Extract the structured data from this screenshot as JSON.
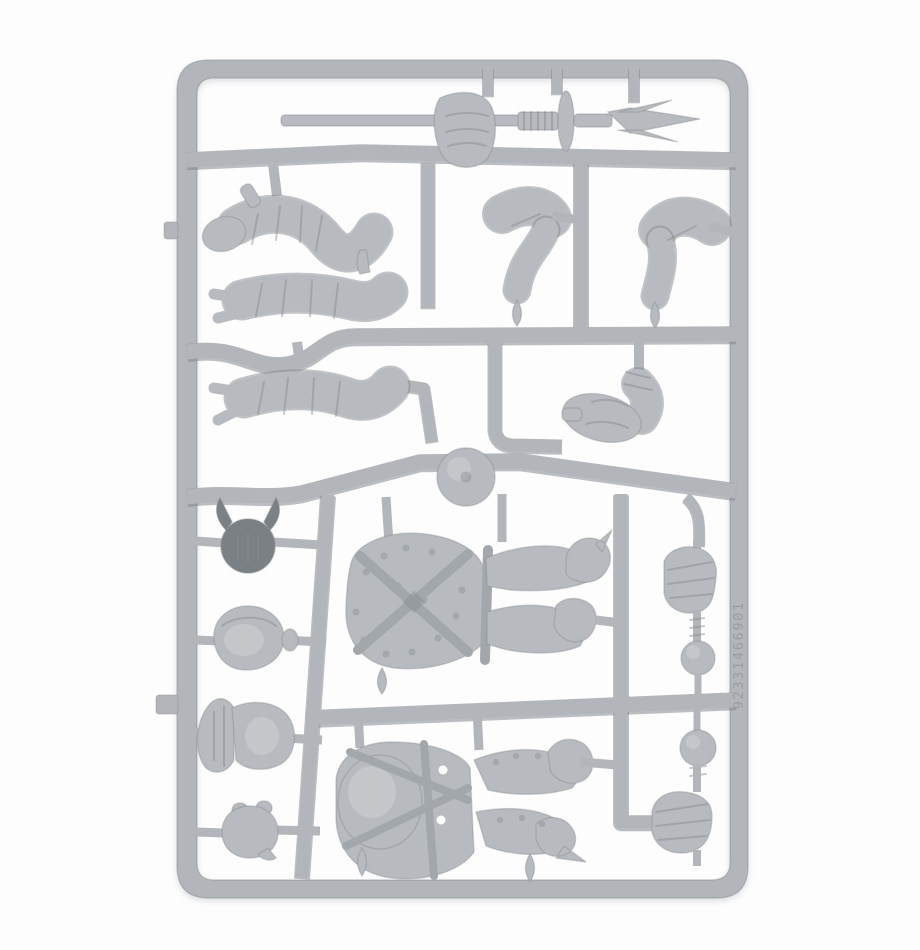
{
  "photo": {
    "subject": "grey plastic miniature model sprue on white background",
    "embossed_code": "92331466901",
    "parts": [
      {
        "id": "sprue-frame",
        "label": "rectangular runner frame"
      },
      {
        "id": "spear",
        "label": "two-pronged spear with gripping hand"
      },
      {
        "id": "arm-1",
        "label": "bandaged bent arm"
      },
      {
        "id": "arm-2",
        "label": "bandaged straight arm"
      },
      {
        "id": "arm-3",
        "label": "bandaged straight arm"
      },
      {
        "id": "leg-left",
        "label": "bent leg"
      },
      {
        "id": "leg-right",
        "label": "bent leg"
      },
      {
        "id": "booted-leg",
        "label": "wrapped booted leg"
      },
      {
        "id": "moulding-disc",
        "label": "round sprue disc"
      },
      {
        "id": "body-upper",
        "label": "torso with crossed straps and studded armour, legs attached"
      },
      {
        "id": "body-lower",
        "label": "body with round belly plate, harness and legs"
      },
      {
        "id": "helmet-winged",
        "label": "dark helmet with wing crest"
      },
      {
        "id": "helmet-open",
        "label": "open-faced round helmet"
      },
      {
        "id": "helmet-crested",
        "label": "helmet with fan crest"
      },
      {
        "id": "head-small",
        "label": "small bare head"
      },
      {
        "id": "fist-mace-1",
        "label": "fist gripping haft with ball pommel"
      },
      {
        "id": "fist-mace-2",
        "label": "fist gripping haft with ball pommel"
      }
    ]
  },
  "colors": {
    "bg": "#fdfdfe",
    "plastic": "#b2b6ba",
    "plastic_part": "#b7bbbf",
    "plastic_light": "#cdd1d4",
    "plastic_strap": "#a2a7ac",
    "plastic_deep": "#84898e",
    "helmet_dark": "#7b8085"
  }
}
